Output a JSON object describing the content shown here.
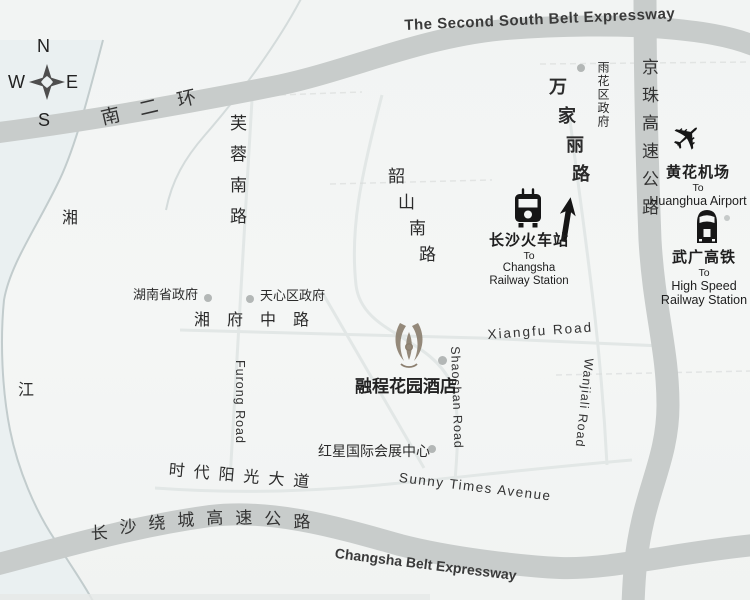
{
  "colors": {
    "background": "#f3f5f4",
    "expressway_band": "#c8cccb",
    "minor_road": "#e2e7e6",
    "river_tint": "#eaf0f1",
    "river_line": "#c2cccd",
    "label_dark": "#2b2b2b",
    "marker_dot": "#b3b7b6",
    "hotel_logo": "#8c8070",
    "icon_black": "#1c1c1c"
  },
  "compass": {
    "n": "N",
    "w": "W",
    "e": "E",
    "s": "S"
  },
  "expressways": {
    "south_belt_cn": "南二环",
    "south_belt_en": "The Second South Belt Expressway",
    "jingzhu_cn": "京珠高速公路",
    "ring_belt_cn": "长沙绕城高速公路",
    "ring_belt_en": "Changsha Belt Expressway"
  },
  "roads": {
    "furong_cn": "芙蓉南路",
    "furong_en": "Furong Road",
    "shaoshan_cn": "韶山南路",
    "shaoshan_en": "Shaoshan Road",
    "wanjiali_cn": "万家丽路",
    "wanjiali_en": "Wanjiali Road",
    "xiangfu_cn": "湘府中路",
    "xiangfu_en": "Xiangfu Road",
    "sunshine_cn": "时代阳光大道",
    "sunshine_en": "Sunny Times Avenue"
  },
  "river": {
    "char1": "湘",
    "char2": "江"
  },
  "places": {
    "yuhua_gov": "雨花区政府",
    "hunan_gov": "湖南省政府",
    "tianxin_gov": "天心区政府",
    "hongxing": "红星国际会展中心",
    "hotel": "融程花园酒店"
  },
  "destinations": {
    "railway": {
      "cn": "长沙火车站",
      "to": "To",
      "line1": "Changsha",
      "line2": "Railway Station"
    },
    "airport": {
      "cn": "黄花机场",
      "to": "To",
      "line1": "Huanghua Airport"
    },
    "hsr": {
      "cn": "武广高铁",
      "to": "To",
      "line1": "High Speed",
      "line2": "Railway Station"
    }
  },
  "icons": {
    "plane_glyph": "✈"
  }
}
